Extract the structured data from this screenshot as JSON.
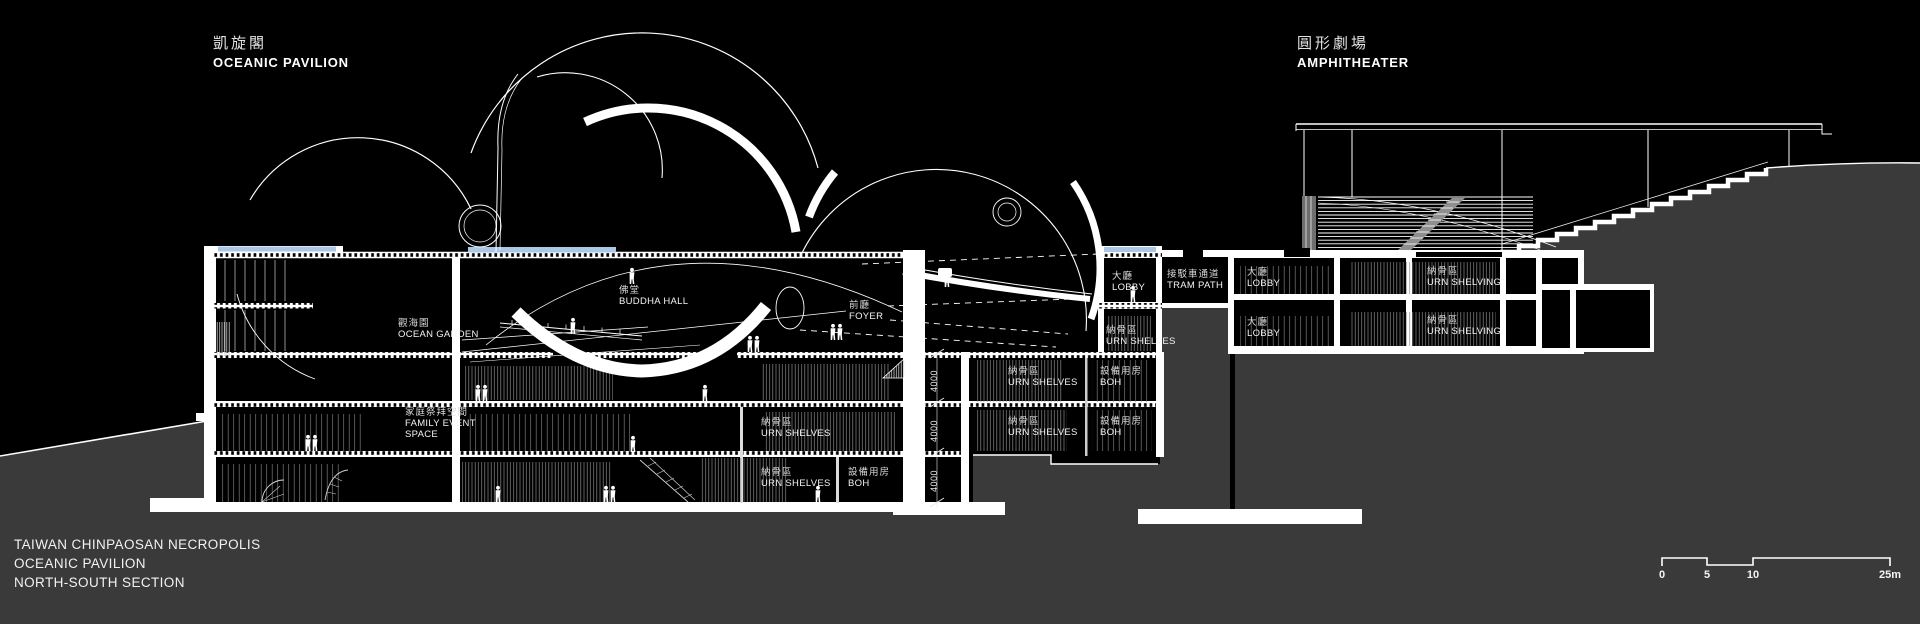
{
  "header": {
    "left": {
      "zh": "凱旋閣",
      "en": "OCEANIC PAVILION"
    },
    "right": {
      "zh": "圓形劇場",
      "en": "AMPHITHEATER"
    }
  },
  "title_block": {
    "line1": "TAIWAN CHINPAOSAN NECROPOLIS",
    "line2": "OCEANIC PAVILION",
    "line3": "NORTH-SOUTH SECTION"
  },
  "scale_bar": {
    "t0": "0",
    "t5": "5",
    "t10": "10",
    "t25": "25m"
  },
  "dimensions": {
    "floor_height": "4000"
  },
  "labels": {
    "ocean_garden": {
      "zh": "觀海園",
      "en": "OCEAN GARDEN"
    },
    "buddha_hall": {
      "zh": "佛堂",
      "en": "BUDDHA HALL"
    },
    "foyer": {
      "zh": "前廳",
      "en": "FOYER"
    },
    "family_event": {
      "zh": "家庭祭拜空間",
      "en1": "FAMILY EVENT",
      "en2": "SPACE"
    },
    "main_lobby": {
      "zh": "大廳",
      "en": "LOBBY"
    },
    "main_urn": {
      "zh": "納骨區",
      "en": "URN SHELVES"
    },
    "tram_path": {
      "zh": "接駁車通道",
      "en": "TRAM PATH"
    },
    "east_lobby_up": {
      "zh": "大廳",
      "en": "LOBBY"
    },
    "east_urn_up": {
      "zh": "納骨區",
      "en": "URN SHELVING"
    },
    "east_lobby_lo": {
      "zh": "大廳",
      "en": "LOBBY"
    },
    "east_urn_lo": {
      "zh": "納骨區",
      "en": "URN SHELVING"
    },
    "r1_urn": {
      "zh": "納骨區",
      "en": "URN SHELVES"
    },
    "r1_boh": {
      "zh": "設備用房",
      "en": "BOH"
    },
    "r2_urn": {
      "zh": "納骨區",
      "en": "URN SHELVES"
    },
    "r2_boh": {
      "zh": "設備用房",
      "en": "BOH"
    },
    "l2_urn": {
      "zh": "納骨區",
      "en": "URN SHELVES"
    },
    "l3_urn": {
      "zh": "納骨區",
      "en": "URN SHELVES"
    },
    "l3_boh": {
      "zh": "設備用房",
      "en": "BOH"
    }
  },
  "colors": {
    "background": "#000000",
    "ground": "#3a3a3a",
    "linework": "#ffffff",
    "water": "#aac8e6"
  }
}
